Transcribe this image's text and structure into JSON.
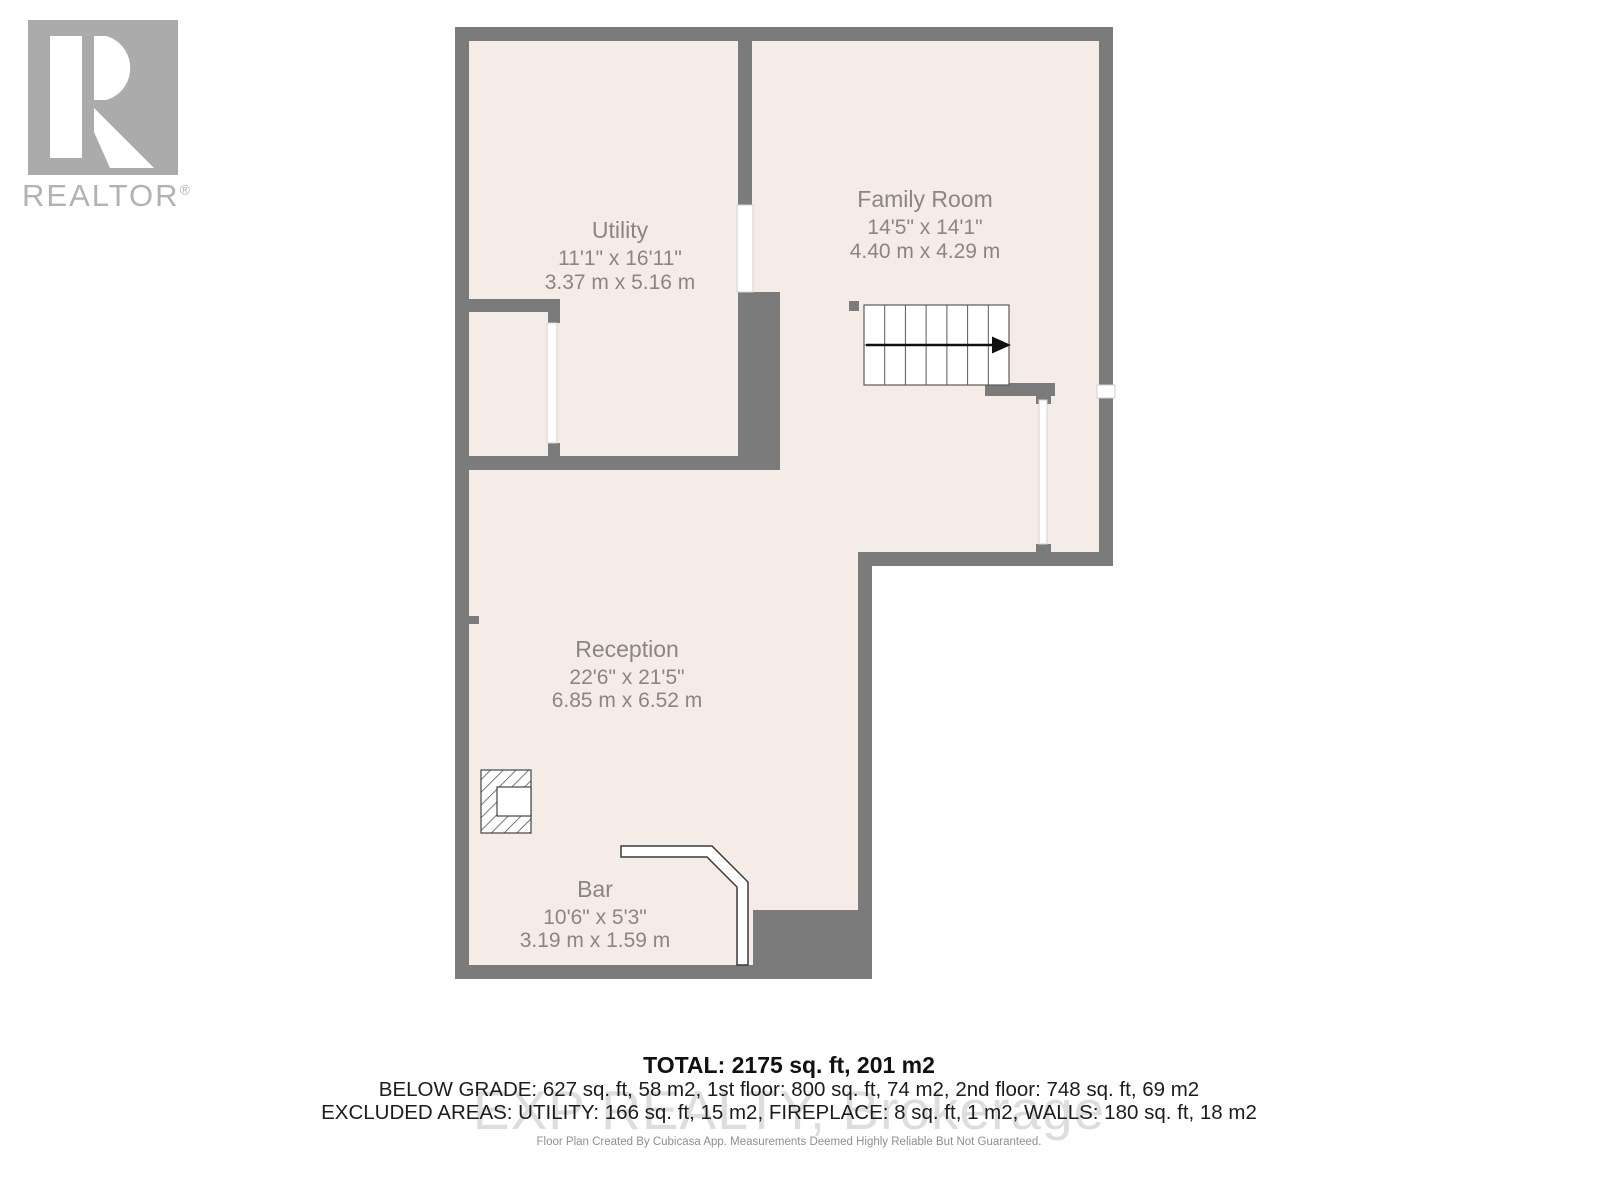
{
  "branding": {
    "logo_letter": "R",
    "realtor_label": "REALTOR",
    "registered_mark": "®"
  },
  "rooms": [
    {
      "name": "Utility",
      "dimensions_imperial": "11'1\" x 16'11\"",
      "dimensions_metric": "3.37 m x 5.16 m"
    },
    {
      "name": "Family Room",
      "dimensions_imperial": "14'5\" x 14'1\"",
      "dimensions_metric": "4.40 m x 4.29 m"
    },
    {
      "name": "Reception",
      "dimensions_imperial": "22'6\" x 21'5\"",
      "dimensions_metric": "6.85 m x 6.52 m"
    },
    {
      "name": "Bar",
      "dimensions_imperial": "10'6\" x 5'3\"",
      "dimensions_metric": "3.19 m x 1.59 m"
    }
  ],
  "summary": {
    "total": "TOTAL: 2175 sq. ft, 201 m2",
    "floor_breakdown": "BELOW GRADE: 627 sq. ft, 58 m2, 1st floor: 800 sq. ft, 74 m2, 2nd floor: 748 sq. ft, 69 m2",
    "excluded_areas": "EXCLUDED AREAS: UTILITY: 166 sq. ft, 15 m2, FIREPLACE: 8 sq. ft, 1 m2, WALLS: 180 sq. ft, 18 m2",
    "disclaimer": "Floor Plan Created By Cubicasa App. Measurements Deemed Highly Reliable But Not Guaranteed."
  },
  "watermark": "EXP REALTY, Brokerage",
  "colors": {
    "wall": "#7b7b7b",
    "floor": "#f6ece7",
    "room_label": "#8b8680",
    "logo_gray": "#ababab",
    "summary_text": "#111111"
  }
}
